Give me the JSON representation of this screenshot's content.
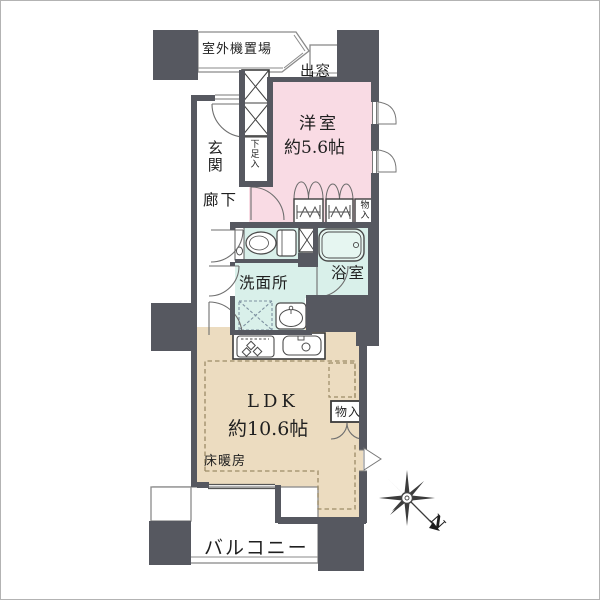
{
  "floorplan": {
    "labels": {
      "outdoor_unit": "室外機置場",
      "bay_window": "出窓",
      "western_room": "洋室",
      "western_room_size": "約5.6帖",
      "entrance": "玄関",
      "shoe_cabinet": "下足入",
      "hallway": "廊下",
      "closet_bedroom": "物入",
      "washroom": "洗面所",
      "bathroom": "浴室",
      "ldk": "LDK",
      "ldk_size": "約10.6帖",
      "floor_heating": "床暖房",
      "closet_ldk": "物入",
      "balcony": "バルコニー"
    },
    "compass": {
      "north_label": "N"
    },
    "colors": {
      "wall": "#565860",
      "western_room_fill": "#f9dbe4",
      "ldk_fill": "#ecdcc0",
      "wet_area_fill": "#d9f0ea",
      "outline": "#8a8a8a",
      "text": "#1f1f1f"
    }
  }
}
